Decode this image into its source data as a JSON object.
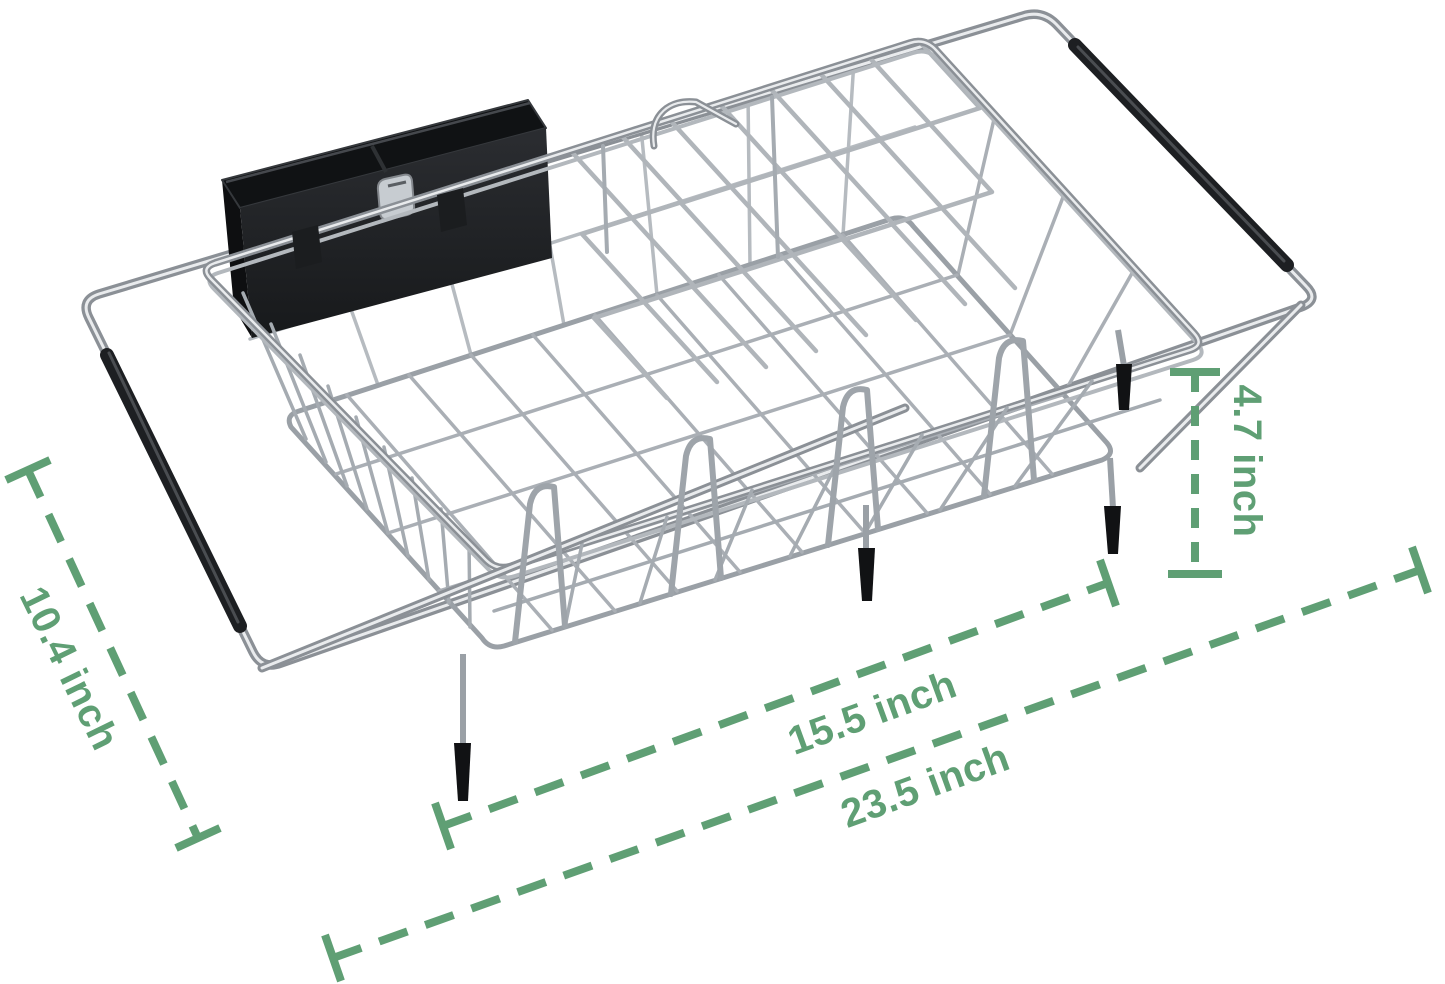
{
  "figure": {
    "kind": "product-dimension-illustration",
    "subject": "expandable over-sink stainless steel dish drying rack with black utensil holder",
    "background_color": "#ffffff"
  },
  "annotations": {
    "color": "#5f9f74",
    "width": {
      "label": "10.4 inch"
    },
    "rack_length": {
      "label": "15.5 inch"
    },
    "extended_length": {
      "label": "23.5 inch"
    },
    "height": {
      "label": "4.7 inch"
    }
  },
  "materials": {
    "chrome_wire": "#a7acb2",
    "chrome_highlight": "#e9ebed",
    "rubber_and_plastic_black": "#1d1f22"
  }
}
